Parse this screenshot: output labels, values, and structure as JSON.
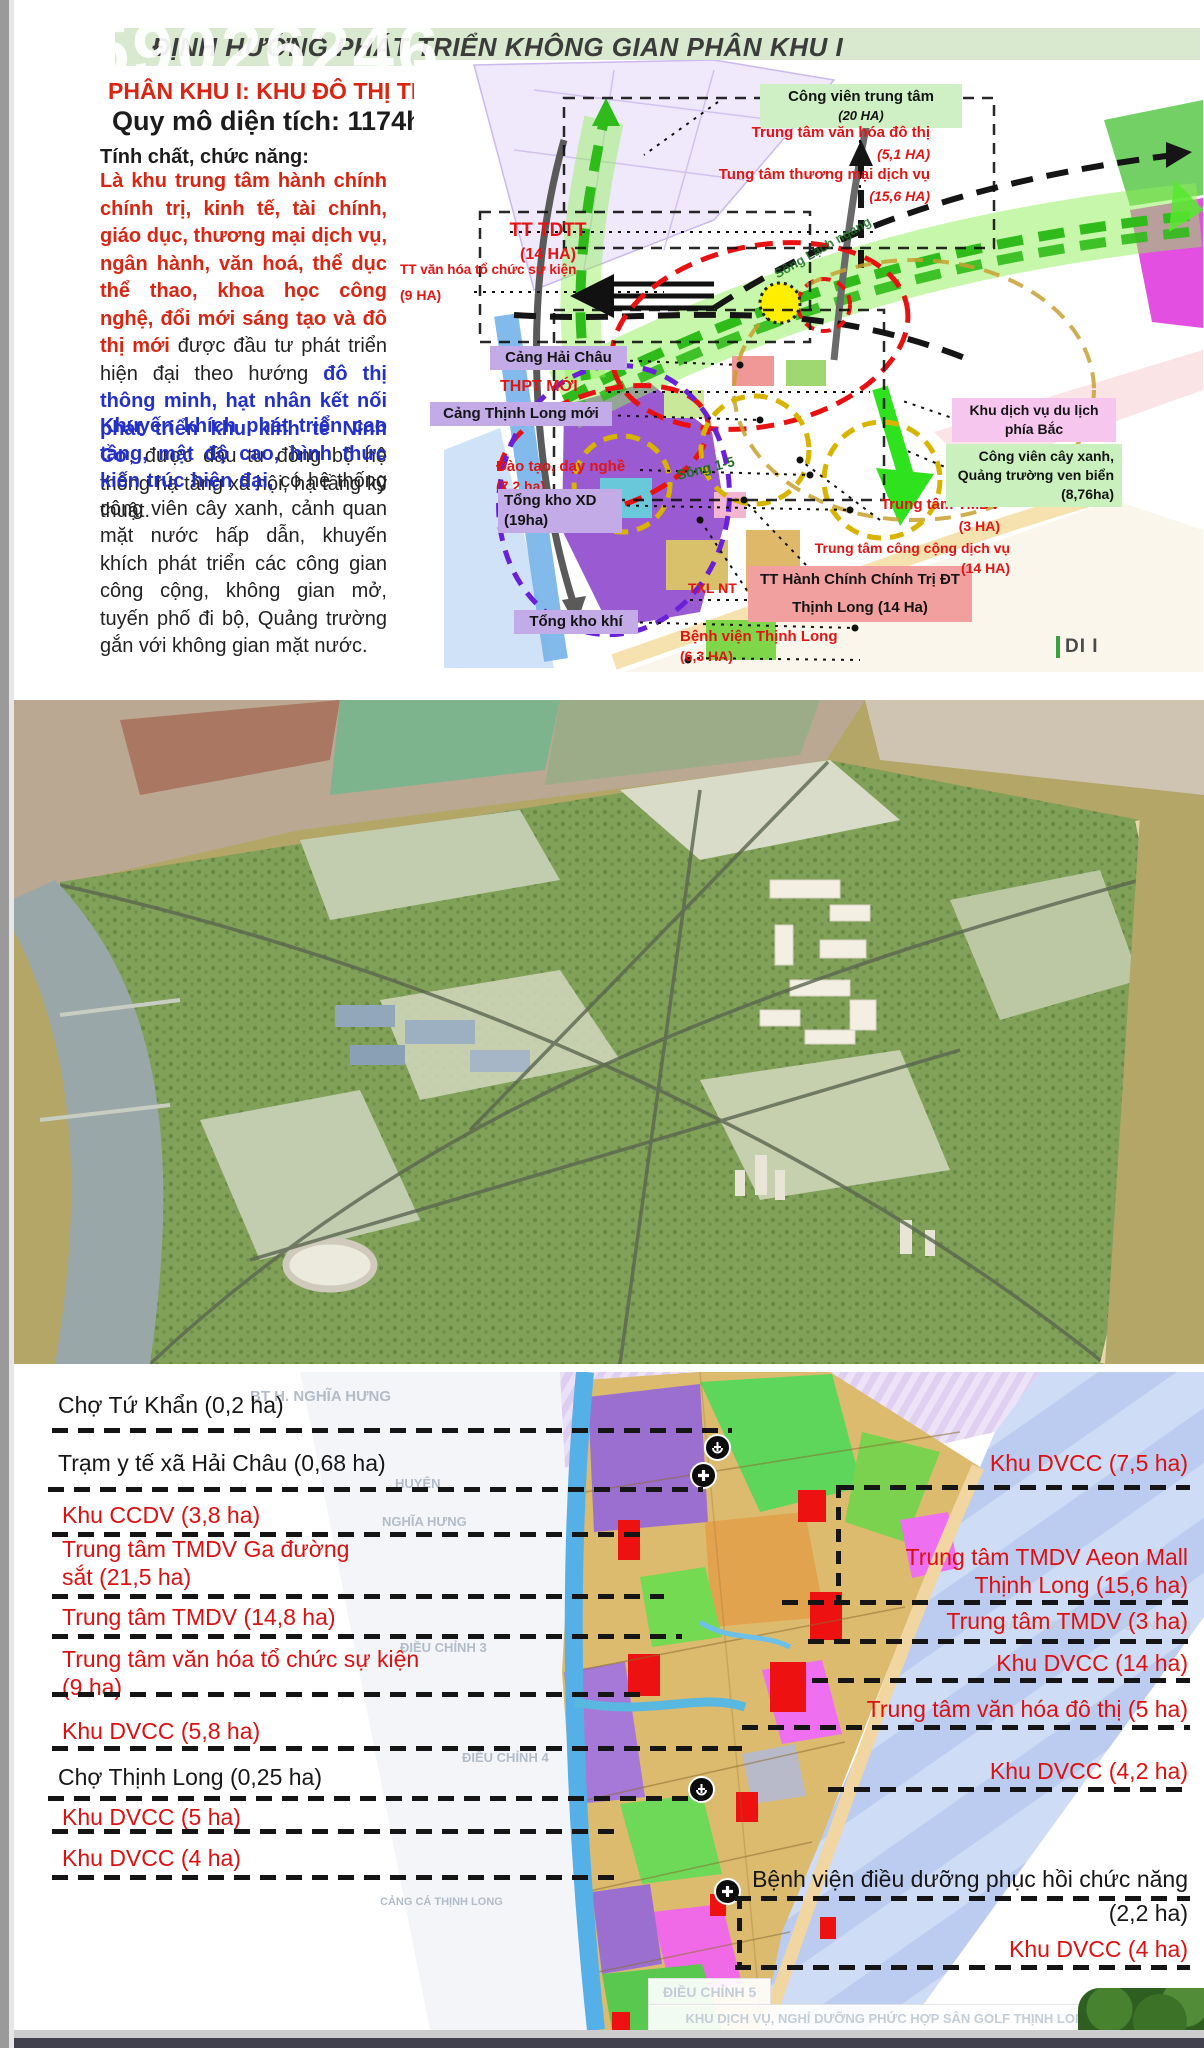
{
  "watermark": "59026246",
  "colors": {
    "header_bar": "#d8e9cf",
    "accent_red": "#d92512",
    "accent_blue": "#2431c8",
    "label_red": "#dc1010",
    "box_purple": "#c3abe8",
    "box_pink": "#f6c6ef",
    "box_green": "#c9f0bd",
    "box_salmon": "#f29f9f",
    "sea_blue": "#c6d5f3",
    "river_blue": "#56b0e8"
  },
  "slide": {
    "header_title": "ĐỊNH HƯỚNG PHÁT TRIỂN KHÔNG GIAN PHÂN KHU I",
    "subtitle": "PHÂN KHU I:  KHU ĐÔ THỊ TRUNG TÂM",
    "area": "Quy mô diện tích: 1174ha",
    "section_heading": "Tính chất, chức năng:",
    "p1": [
      {
        "c": "red",
        "t": "Là khu trung tâm hành chính chính trị, kinh tế, tài chính, giáo dục, thương mại dịch vụ, ngân hành, văn hoá, thể dục thể thao, khoa học công nghệ, đổi mới sáng tạo và đô thị mới "
      },
      {
        "c": "black",
        "t": "được đầu tư phát triển hiện đại theo hướng "
      },
      {
        "c": "blue",
        "t": "đô thị thông minh, hạt nhân kết nối phát triển khu kinh tế Ninh Cơ"
      },
      {
        "c": "black",
        "t": ", được đầu tư đồng bộ hệ thống hạ tầng xã hội, hạ tầng kỹ thuật."
      }
    ],
    "p2": [
      {
        "c": "blue",
        "t": "Khuyến khích phát triển cao tầng, mật độ cao, hình thức kiến trúc hiện đại,"
      },
      {
        "c": "black",
        "t": " có hệ thống công viên cây xanh, cảnh quan mặt nước hấp dẫn, khuyến khích phát triển các công gian công cộng, không gian mở, tuyến phố đi bộ, Quảng trường gắn với không gian mặt nước."
      }
    ],
    "logo": "DI I",
    "map": {
      "cv1": "Công viên trung tâm",
      "cv2": "(20 HA)",
      "vhdt1": "Trung tâm văn hóa đô thị",
      "vhdt2": "(5,1 HA)",
      "tmdv_a": "Tung tâm thương mại dịch vụ",
      "tmdv_b": "(15,6 HA)",
      "tdtt1": "TT TDTT",
      "tdtt2": "(14 HA)",
      "vhsk1": "TT văn hóa tổ chức sự kiện",
      "vhsk2": "(9 HA)",
      "cang_hai_chau": "Cảng Hải Châu",
      "thpt": "THPT MỚI",
      "cang_thinh_long": "Cảng Thịnh Long mới",
      "dtdn1": "Đào tạo, dạy nghề",
      "dtdn2": "(7,2 ha)",
      "tkxd1": "Tổng kho XD",
      "tkxd2": "(19ha)",
      "tong_kho_khi": "Tổng kho khí",
      "txl": "TXL NT",
      "hc1": "TT Hành Chính Chính Trị ĐT",
      "hc2": "Thịnh Long (14 Ha)",
      "bv1": "Bệnh viện Thịnh Long",
      "bv2": "(6,3 HA)",
      "tmdv3_1": "Trung tâm TMDV",
      "tmdv3_2": "(3 HA)",
      "ccdv1": "Trung tâm công cộng dịch vụ",
      "ccdv2": "(14 HA)",
      "dulich1": "Khu dịch vụ du lịch",
      "dulich2": "phía Bắc",
      "cvx1": "Công viên cây xanh,",
      "cvx2": "Quảng trường ven biển",
      "cvx3": "(8,76ha)",
      "song15": "Sông 1-5",
      "songlach": "Sông Lạch ngang"
    }
  },
  "bottom": {
    "left": {
      "l1": "Chợ Tứ Khẩn (0,2 ha)",
      "l2": "Trạm y tế xã Hải Châu (0,68 ha)",
      "l3": "Khu CCDV (3,8 ha)",
      "l4a": "Trung tâm TMDV Ga đường",
      "l4b": "sắt (21,5 ha)",
      "l5": "Trung tâm TMDV (14,8 ha)",
      "l6a": "Trung tâm văn hóa tổ chức sự kiện",
      "l6b": "(9 ha)",
      "l7": "Khu DVCC (5,8 ha)",
      "l8": "Chợ Thịnh Long (0,25 ha)",
      "l9": "Khu DVCC (5 ha)",
      "l10": "Khu DVCC (4 ha)"
    },
    "right": {
      "r1": "Khu DVCC (7,5 ha)",
      "r2a": "Trung tâm TMDV Aeon Mall",
      "r2b": "Thịnh Long (15,6 ha)",
      "r3": "Trung tâm TMDV (3 ha)",
      "r4": "Khu DVCC (14 ha)",
      "r5": "Trung tâm văn hóa đô thị (5 ha)",
      "r6": "Khu DVCC (4,2 ha)",
      "r7a": "Bệnh viện điều dưỡng phục hồi chức năng",
      "r7b": "(2,2 ha)",
      "r8": "Khu DVCC (4 ha)"
    },
    "faint": {
      "f1": "BT H. NGHĨA HƯNG",
      "f2": "HUYỆN",
      "f3": "NGHĨA HƯNG",
      "f4": "ĐIỀU CHỈNH 3",
      "f5": "ĐIỀU CHỈNH 4",
      "f6": "ĐIỀU CHỈNH 5",
      "f7": "PHÁT TRIỂN KHÔNG GIAN BIỂN",
      "f8": "KHU DỊCH VỤ, NGHỈ DƯỠNG PHỨC HỢP SÂN GOLF THỊNH LONG",
      "f9": "(QUY MÔ DỰ KIẾN 176HA)",
      "f10": "CẢNG CÁ THỊNH LONG"
    }
  }
}
